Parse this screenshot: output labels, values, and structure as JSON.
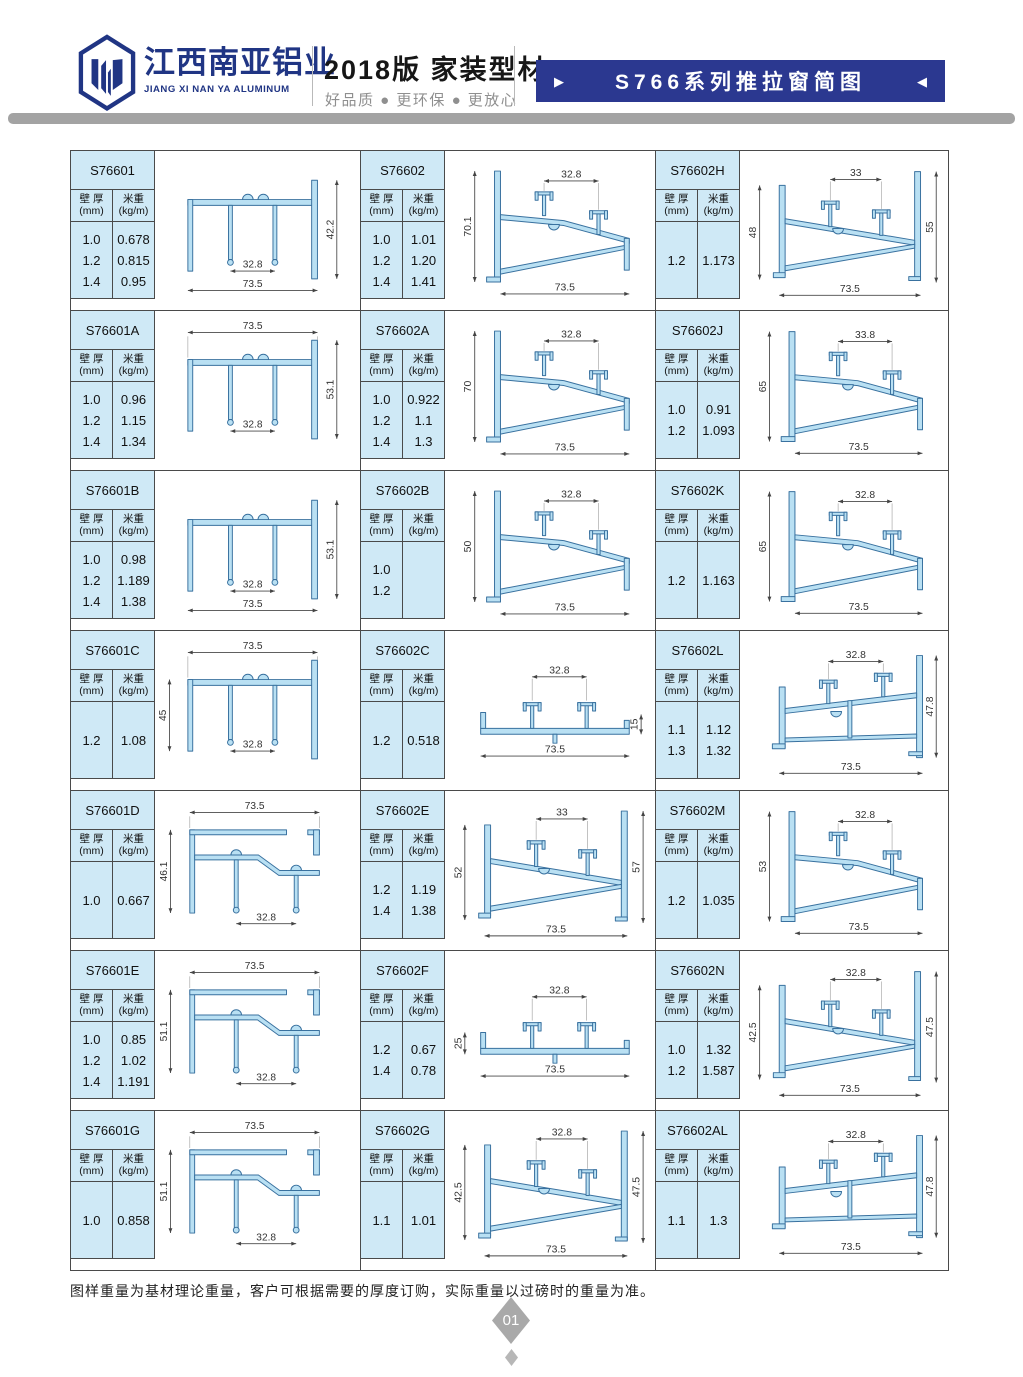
{
  "header": {
    "brand_cn": "江西南亚铝业",
    "brand_en": "JIANG XI NAN YA ALUMINUM",
    "edition": "2018版  家装型材",
    "slogan": "好品质 ● 更环保 ● 更放心",
    "banner_title": "S766系列推拉窗简图",
    "banner_left_arrow": "▶",
    "banner_right_arrow": "◀"
  },
  "table_labels": {
    "thickness": "壁 厚",
    "thickness_unit": "(mm)",
    "weight": "米重",
    "weight_unit": "(kg/m)"
  },
  "cells": [
    {
      "code": "S76601",
      "rows": [
        [
          "1.0",
          "0.678"
        ],
        [
          "1.2",
          "0.815"
        ],
        [
          "1.4",
          "0.95"
        ]
      ],
      "drawing": {
        "type": "frame",
        "dims": {
          "inner": "32.8",
          "bottom": "73.5",
          "right": "42.2"
        }
      }
    },
    {
      "code": "S76602",
      "rows": [
        [
          "1.0",
          "1.01"
        ],
        [
          "1.2",
          "1.20"
        ],
        [
          "1.4",
          "1.41"
        ]
      ],
      "drawing": {
        "type": "sash",
        "dims": {
          "top": "32.8",
          "left": "70.1",
          "bottom": "73.5"
        }
      }
    },
    {
      "code": "S76602H",
      "rows": [
        [
          "1.2",
          "1.173"
        ]
      ],
      "drawing": {
        "type": "sash2",
        "dims": {
          "top": "33",
          "left": "48",
          "right": "55",
          "bottom": "73.5"
        }
      }
    },
    {
      "code": "S76601A",
      "rows": [
        [
          "1.0",
          "0.96"
        ],
        [
          "1.2",
          "1.15"
        ],
        [
          "1.4",
          "1.34"
        ]
      ],
      "drawing": {
        "type": "frame",
        "dims": {
          "top": "73.5",
          "inner": "32.8",
          "right": "53.1"
        }
      }
    },
    {
      "code": "S76602A",
      "rows": [
        [
          "1.0",
          "0.922"
        ],
        [
          "1.2",
          "1.1"
        ],
        [
          "1.4",
          "1.3"
        ]
      ],
      "drawing": {
        "type": "sash",
        "dims": {
          "top": "32.8",
          "left": "70",
          "bottom": "73.5"
        }
      }
    },
    {
      "code": "S76602J",
      "rows": [
        [
          "1.0",
          "0.91"
        ],
        [
          "1.2",
          "1.093"
        ]
      ],
      "drawing": {
        "type": "sash",
        "dims": {
          "top": "33.8",
          "left": "65",
          "bottom": "73.5"
        }
      }
    },
    {
      "code": "S76601B",
      "rows": [
        [
          "1.0",
          "0.98"
        ],
        [
          "1.2",
          "1.189"
        ],
        [
          "1.4",
          "1.38"
        ]
      ],
      "drawing": {
        "type": "frame",
        "dims": {
          "inner": "32.8",
          "bottom": "73.5",
          "right": "53.1"
        }
      }
    },
    {
      "code": "S76602B",
      "rows": [
        [
          "1.0",
          ""
        ],
        [
          "1.2",
          ""
        ]
      ],
      "drawing": {
        "type": "sash",
        "dims": {
          "top": "32.8",
          "left": "50",
          "bottom": "73.5"
        }
      }
    },
    {
      "code": "S76602K",
      "rows": [
        [
          "1.2",
          "1.163"
        ]
      ],
      "drawing": {
        "type": "sash",
        "dims": {
          "top": "32.8",
          "left": "65",
          "bottom": "73.5"
        }
      }
    },
    {
      "code": "S76601C",
      "rows": [
        [
          "1.2",
          "1.08"
        ]
      ],
      "drawing": {
        "type": "frame",
        "dims": {
          "top": "73.5",
          "left": "45",
          "inner": "32.8"
        }
      }
    },
    {
      "code": "S76602C",
      "rows": [
        [
          "1.2",
          "0.518"
        ]
      ],
      "drawing": {
        "type": "lowrail",
        "dims": {
          "top": "32.8",
          "right": "15",
          "bottom": "73.5"
        }
      }
    },
    {
      "code": "S76602L",
      "rows": [
        [
          "1.1",
          "1.12"
        ],
        [
          "1.3",
          "1.32"
        ]
      ],
      "drawing": {
        "type": "sashflat",
        "dims": {
          "top": "32.8",
          "right": "47.8",
          "bottom": "73.5"
        }
      }
    },
    {
      "code": "S76601D",
      "rows": [
        [
          "1.0",
          "0.667"
        ]
      ],
      "drawing": {
        "type": "frameL",
        "dims": {
          "top": "73.5",
          "left": "46.1",
          "inner": "32.8"
        }
      }
    },
    {
      "code": "S76602E",
      "rows": [
        [
          "1.2",
          "1.19"
        ],
        [
          "1.4",
          "1.38"
        ]
      ],
      "drawing": {
        "type": "sash2",
        "dims": {
          "top": "33",
          "left": "52",
          "right": "57",
          "bottom": "73.5"
        }
      }
    },
    {
      "code": "S76602M",
      "rows": [
        [
          "1.2",
          "1.035"
        ]
      ],
      "drawing": {
        "type": "sash",
        "dims": {
          "top": "32.8",
          "left": "53",
          "bottom": "73.5"
        }
      }
    },
    {
      "code": "S76601E",
      "rows": [
        [
          "1.0",
          "0.85"
        ],
        [
          "1.2",
          "1.02"
        ],
        [
          "1.4",
          "1.191"
        ]
      ],
      "drawing": {
        "type": "frameL",
        "dims": {
          "top": "73.5",
          "left": "51.1",
          "inner": "32.8"
        }
      }
    },
    {
      "code": "S76602F",
      "rows": [
        [
          "1.2",
          "0.67"
        ],
        [
          "1.4",
          "0.78"
        ]
      ],
      "drawing": {
        "type": "lowrail",
        "dims": {
          "top": "32.8",
          "left": "25",
          "bottom": "73.5"
        }
      }
    },
    {
      "code": "S76602N",
      "rows": [
        [
          "1.0",
          "1.32"
        ],
        [
          "1.2",
          "1.587"
        ]
      ],
      "drawing": {
        "type": "sash2",
        "dims": {
          "top": "32.8",
          "left": "42.5",
          "right": "47.5",
          "bottom": "73.5"
        }
      }
    },
    {
      "code": "S76601G",
      "rows": [
        [
          "1.0",
          "0.858"
        ]
      ],
      "drawing": {
        "type": "frameL",
        "dims": {
          "top": "73.5",
          "left": "51.1",
          "inner": "32.8"
        }
      }
    },
    {
      "code": "S76602G",
      "rows": [
        [
          "1.1",
          "1.01"
        ]
      ],
      "drawing": {
        "type": "sash2",
        "dims": {
          "top": "32.8",
          "left": "42.5",
          "right": "47.5",
          "bottom": "73.5"
        }
      }
    },
    {
      "code": "S76602AL",
      "rows": [
        [
          "1.1",
          "1.3"
        ]
      ],
      "drawing": {
        "type": "sashflat",
        "dims": {
          "top": "32.8",
          "right": "47.8",
          "bottom": "73.5"
        }
      }
    }
  ],
  "footer": {
    "note": "图样重量为基材理论重量，客户可根据需要的厚度订购，实际重量以过磅时的重量为准。",
    "page": "01"
  },
  "colors": {
    "banner": "#2b3890",
    "accent_navy": "#203584",
    "table_bg": "#cfe9f6",
    "profile_fill": "#b9e0f3",
    "profile_stroke": "#39719f",
    "bar_gray": "#a3a3a3"
  }
}
